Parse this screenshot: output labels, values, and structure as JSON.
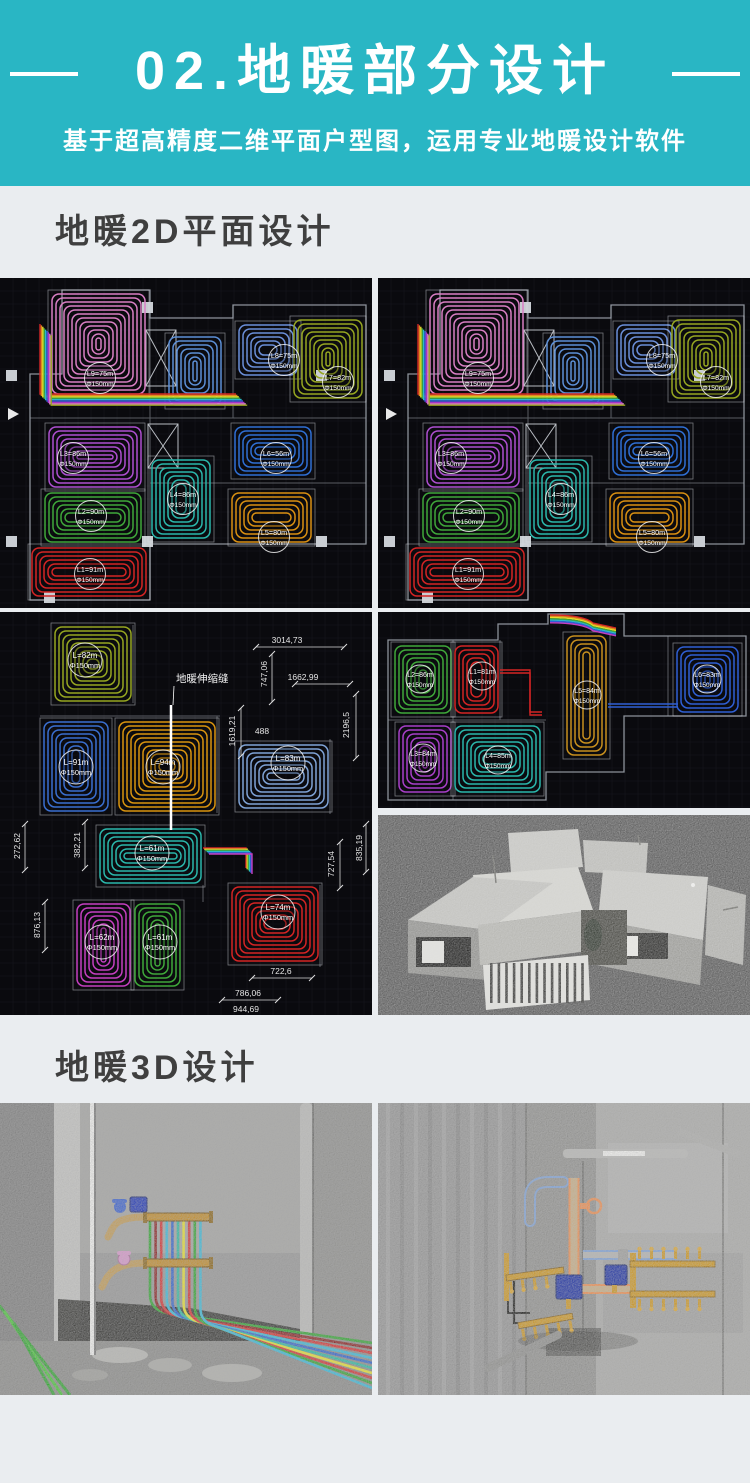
{
  "header": {
    "title": "02.地暖部分设计",
    "subtitle": "基于超高精度二维平面户型图，运用专业地暖设计软件"
  },
  "sections": {
    "s2d": "地暖2D平面设计",
    "s3d": "地暖3D设计"
  },
  "colors": {
    "accent": "#29B6C4",
    "page_bg": "#EAEDF0",
    "heading": "#3F3F3F",
    "cad_bg": "#0A0A0E",
    "grid": "#16161F",
    "wall": "#9AA0A8"
  },
  "plans": {
    "top": {
      "name": "cad-plan-overview",
      "labelR": 15.5,
      "labelFont": 7.2,
      "outline": "M62,12 H150 V40 H233 V27 H366 V266 H150 V322 H30 V96 H62 Z",
      "inner": "M30,140 H366 M150,40 V322 M150,205 H366 M233,27 V140 M62,12 V96",
      "columns": [
        [
          6,
          92
        ],
        [
          6,
          258
        ],
        [
          142,
          24
        ],
        [
          142,
          258
        ],
        [
          316,
          92
        ],
        [
          316,
          258
        ],
        [
          44,
          314
        ]
      ],
      "xshafts": [
        [
          146,
          52,
          30,
          56
        ],
        [
          148,
          146,
          30,
          44
        ]
      ],
      "arrow": [
        8,
        136
      ],
      "bundles": [
        {
          "d": "M40,46 V116 H236",
          "dx": 1.4,
          "dy": 1.4,
          "colors": [
            "#D42424",
            "#E08A1E",
            "#E8DC2C",
            "#3FA83A",
            "#2BB8C8",
            "#2F5FD4",
            "#A832C8",
            "#D97FC4",
            "#96A621"
          ]
        }
      ],
      "rooms": [
        {
          "label": "L9=75m",
          "dia": "Φ150mm",
          "color": "#D97FC4",
          "x": 50,
          "y": 14,
          "w": 97,
          "h": 104,
          "lx": 100,
          "ly": 100
        },
        {
          "color": "#5C8FD6",
          "x": 167,
          "y": 57,
          "w": 56,
          "h": 72
        },
        {
          "label": "L8=75m",
          "dia": "Φ150mm",
          "color": "#6B8FD9",
          "x": 237,
          "y": 45,
          "w": 62,
          "h": 54,
          "lx": 284,
          "ly": 82
        },
        {
          "label": "L7=82m",
          "dia": "Φ150mm",
          "color": "#96A621",
          "x": 292,
          "y": 40,
          "w": 72,
          "h": 82,
          "lx": 338,
          "ly": 104
        },
        {
          "label": "L3=86m",
          "dia": "Φ150mm",
          "color": "#AE4FD0",
          "x": 47,
          "y": 147,
          "w": 96,
          "h": 64,
          "lx": 73,
          "ly": 180
        },
        {
          "label": "L6=56m",
          "dia": "Φ150mm",
          "color": "#2F6FD4",
          "x": 233,
          "y": 147,
          "w": 80,
          "h": 52,
          "lx": 276,
          "ly": 180
        },
        {
          "label": "L4=86m",
          "dia": "Φ150mm",
          "color": "#2BB8AC",
          "x": 150,
          "y": 180,
          "w": 62,
          "h": 82,
          "lx": 183,
          "ly": 221
        },
        {
          "label": "L2=90m",
          "dia": "Φ150mm",
          "color": "#3FA83A",
          "x": 43,
          "y": 213,
          "w": 100,
          "h": 53,
          "lx": 91,
          "ly": 238
        },
        {
          "label": "L5=80m",
          "dia": "Φ150mm",
          "color": "#D99012",
          "x": 230,
          "y": 213,
          "w": 83,
          "h": 53,
          "lx": 274,
          "ly": 259
        },
        {
          "label": "L1=91m",
          "dia": "Φ150mm",
          "color": "#D42424",
          "x": 30,
          "y": 268,
          "w": 118,
          "h": 52,
          "lx": 90,
          "ly": 296
        }
      ]
    },
    "dim": {
      "name": "cad-plan-dimensions",
      "labelR": 17,
      "labelFont": 8,
      "inner": "M40,104 H220 M133,13 V91 M217,104 V201 M330,127 V202 M203,273 V290 M320,273 V355",
      "note": {
        "text": "地暖伸缩缝",
        "x": 176,
        "y": 70
      },
      "joint": {
        "x": 171,
        "y1": 93,
        "y2": 218
      },
      "bundles": [
        {
          "d": "M203,236 H246 V256",
          "dx": 1.2,
          "dy": 1.2,
          "colors": [
            "#D42424",
            "#E8DC2C",
            "#3FA83A",
            "#2BB8C8",
            "#2F5FD4",
            "#C53FC0"
          ]
        }
      ],
      "rooms": [
        {
          "label": "L=82m",
          "dia": "Φ150mm",
          "color": "#96A621",
          "x": 53,
          "y": 13,
          "w": 80,
          "h": 78,
          "lx": 85,
          "ly": 48
        },
        {
          "label": "L=91m",
          "dia": "Φ150mm",
          "color": "#3A6FD0",
          "x": 42,
          "y": 108,
          "w": 68,
          "h": 93,
          "lx": 76,
          "ly": 155
        },
        {
          "label": "L=94m",
          "dia": "Φ150mm",
          "color": "#D9940F",
          "x": 117,
          "y": 108,
          "w": 100,
          "h": 93,
          "lx": 163,
          "ly": 155
        },
        {
          "label": "L=83m",
          "dia": "Φ150mm",
          "color": "#7FA3D6",
          "x": 237,
          "y": 131,
          "w": 93,
          "h": 67,
          "lx": 288,
          "ly": 151
        },
        {
          "label": "L=61m",
          "dia": "Φ150mm",
          "color": "#2BB8AC",
          "x": 98,
          "y": 215,
          "w": 105,
          "h": 58,
          "lx": 152,
          "ly": 241
        },
        {
          "label": "L=62m",
          "dia": "Φ150mm",
          "color": "#C53FC0",
          "x": 75,
          "y": 290,
          "w": 57,
          "h": 86,
          "lx": 102,
          "ly": 330
        },
        {
          "label": "L=61m",
          "dia": "Φ150mm",
          "color": "#3FA83A",
          "x": 133,
          "y": 290,
          "w": 49,
          "h": 86,
          "lx": 160,
          "ly": 330
        },
        {
          "label": "L=74m",
          "dia": "Φ150mm",
          "color": "#D42424",
          "x": 230,
          "y": 273,
          "w": 90,
          "h": 78,
          "lx": 278,
          "ly": 300
        }
      ],
      "dims": [
        {
          "t": "3014,73",
          "x": 287,
          "y": 31,
          "r": 0
        },
        {
          "t": "747,06",
          "x": 267,
          "y": 62,
          "r": -90
        },
        {
          "t": "1662,99",
          "x": 303,
          "y": 68,
          "r": 0
        },
        {
          "t": "2196,5",
          "x": 349,
          "y": 113,
          "r": -90
        },
        {
          "t": "1619,21",
          "x": 235,
          "y": 119,
          "r": -90
        },
        {
          "t": "488",
          "x": 262,
          "y": 122,
          "r": 0
        },
        {
          "t": "272,62",
          "x": 20,
          "y": 234,
          "r": -90
        },
        {
          "t": "382,21",
          "x": 80,
          "y": 233,
          "r": -90
        },
        {
          "t": "835,19",
          "x": 362,
          "y": 236,
          "r": -90
        },
        {
          "t": "727,54",
          "x": 334,
          "y": 252,
          "r": -90
        },
        {
          "t": "876,13",
          "x": 40,
          "y": 313,
          "r": -90
        },
        {
          "t": "722,6",
          "x": 281,
          "y": 362,
          "r": 0
        },
        {
          "t": "786,06",
          "x": 248,
          "y": 384,
          "r": 0
        },
        {
          "t": "944,69",
          "x": 246,
          "y": 400,
          "r": 0
        }
      ],
      "dimlines": [
        [
          256,
          35,
          344,
          35
        ],
        [
          295,
          72,
          350,
          72
        ],
        [
          272,
          42,
          272,
          90
        ],
        [
          356,
          82,
          356,
          146
        ],
        [
          241,
          96,
          241,
          144
        ],
        [
          25,
          212,
          25,
          258
        ],
        [
          85,
          210,
          85,
          256
        ],
        [
          366,
          212,
          366,
          260
        ],
        [
          340,
          230,
          340,
          276
        ],
        [
          45,
          290,
          45,
          338
        ],
        [
          252,
          366,
          312,
          366
        ],
        [
          222,
          388,
          278,
          388
        ]
      ]
    },
    "wide": {
      "name": "cad-plan-wide",
      "labelR": 14,
      "labelFont": 7,
      "outline": "M10,28 V188 H168 V160 H246 V104 H368 V24 H246 V2 H170 V12 H120 V28 Z",
      "inner": "M10,108 H168 M75,28 V188 M122,28 V108 M290,24 V104",
      "bundles": [
        {
          "d": "M172,3 C196,3 209,6 215,11 L238,16",
          "dx": 0,
          "dy": 1.3,
          "colors": [
            "#D42424",
            "#E08A1E",
            "#E8DC2C",
            "#3FA83A",
            "#2BB8C8",
            "#2F5FD4",
            "#C53FC0"
          ]
        }
      ],
      "connectors": [
        {
          "d": "M230,92 H300",
          "color": "#2F5FD4"
        },
        {
          "d": "M122,58 H152 V100 H164",
          "color": "#D42424"
        }
      ],
      "rooms": [
        {
          "label": "L2=86m",
          "dia": "Φ150mm",
          "color": "#3FA83A",
          "x": 15,
          "y": 32,
          "w": 60,
          "h": 71,
          "lx": 42,
          "ly": 67
        },
        {
          "label": "L1=81m",
          "dia": "Φ150mm",
          "color": "#D42424",
          "x": 75,
          "y": 32,
          "w": 47,
          "h": 71,
          "lx": 104,
          "ly": 64
        },
        {
          "label": "L5=84m",
          "dia": "Φ150mm",
          "color": "#C8901E",
          "x": 187,
          "y": 22,
          "w": 43,
          "h": 123,
          "lx": 209,
          "ly": 83
        },
        {
          "label": "L6=83m",
          "dia": "Φ150mm",
          "color": "#2F5FD4",
          "x": 297,
          "y": 33,
          "w": 65,
          "h": 69,
          "lx": 329,
          "ly": 67
        },
        {
          "label": "L3=84m",
          "dia": "Φ150mm",
          "color": "#A83FC8",
          "x": 19,
          "y": 112,
          "w": 56,
          "h": 70,
          "lx": 45,
          "ly": 146
        },
        {
          "label": "L4=85m",
          "dia": "Φ150mm",
          "color": "#2BB8AC",
          "x": 75,
          "y": 112,
          "w": 89,
          "h": 70,
          "lx": 120,
          "ly": 148
        }
      ]
    }
  },
  "photos": {
    "left": {
      "drop_pipes": [
        "#2FA32F",
        "#8A2020",
        "#D43030",
        "#38B8D8",
        "#2F62CC",
        "#2BB8A0",
        "#E8E22E",
        "#D43030",
        "#2FA32F",
        "#38B8D8"
      ],
      "floor_pipes": [
        "#2FA32F",
        "#47C437",
        "#2FA32F"
      ],
      "brass": "#C08A28",
      "valve_box": "#2238B4",
      "valve_blue": "#3A60CC",
      "valve_pink": "#D898CC"
    },
    "right": {
      "brass": "#C8921E",
      "valve_box": "#1C2F9E",
      "outline_blue": "#7A9CD0",
      "outline_orange": "#E8884A"
    }
  }
}
